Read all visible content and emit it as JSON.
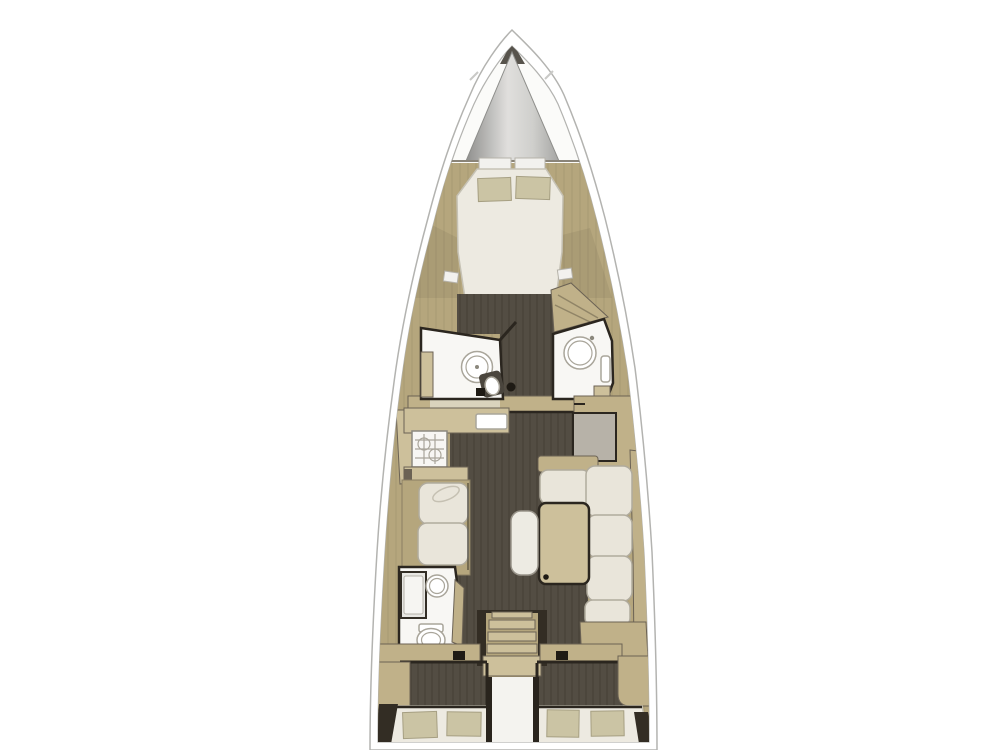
{
  "page": {
    "background": "#ffffff",
    "width": 1000,
    "height": 750
  },
  "diagram": {
    "type": "boat-floor-plan",
    "view": "top-down deck layout",
    "vessel": "sailing-yacht-monohull",
    "areas": [
      {
        "id": "anchor-locker",
        "kind": "bow-locker"
      },
      {
        "id": "forward-cabin",
        "kind": "double-v-berth",
        "pillows": 2
      },
      {
        "id": "forward-head-port",
        "kind": "bathroom-with-round-shower"
      },
      {
        "id": "forward-head-starboard",
        "kind": "bathroom-with-round-basin"
      },
      {
        "id": "galley",
        "kind": "counter-stove-sink"
      },
      {
        "id": "nav-station",
        "kind": "chart-table"
      },
      {
        "id": "port-settee",
        "kind": "two-cushion-sofa"
      },
      {
        "id": "starboard-dinette",
        "kind": "l-shaped-sofa-with-table"
      },
      {
        "id": "salon-table",
        "kind": "wood-table"
      },
      {
        "id": "center-stool",
        "kind": "bench-seat"
      },
      {
        "id": "aft-head-port",
        "kind": "bathroom-shower-sink-toilet"
      },
      {
        "id": "companionway-stairs",
        "kind": "steps",
        "tread_count": 5
      },
      {
        "id": "aft-cabin-port",
        "kind": "double-berth",
        "pillows": 2
      },
      {
        "id": "aft-cabin-starboard",
        "kind": "double-berth",
        "pillows": 2
      },
      {
        "id": "aft-walkway",
        "kind": "passage"
      }
    ]
  },
  "palette": {
    "page-bg": "#ffffff",
    "hull-white": "#ffffff",
    "hull-line": "#b3b3b0",
    "deck-white": "#fbfbf9",
    "wood-base": "#b5a67d",
    "wood-mid": "#c0b189",
    "wood-light": "#cdc09b",
    "sole-dark": "#534d43",
    "wall-dark": "#2b261f",
    "bath-white": "#f8f7f4",
    "cushion-cream": "#e9e5da",
    "pillow-beige": "#cbc4a4",
    "mattress-white": "#edeae1",
    "desk-gray": "#b7b2a8",
    "cone-tip-dark": "#57534c",
    "shadow-dark": "#332d24"
  }
}
